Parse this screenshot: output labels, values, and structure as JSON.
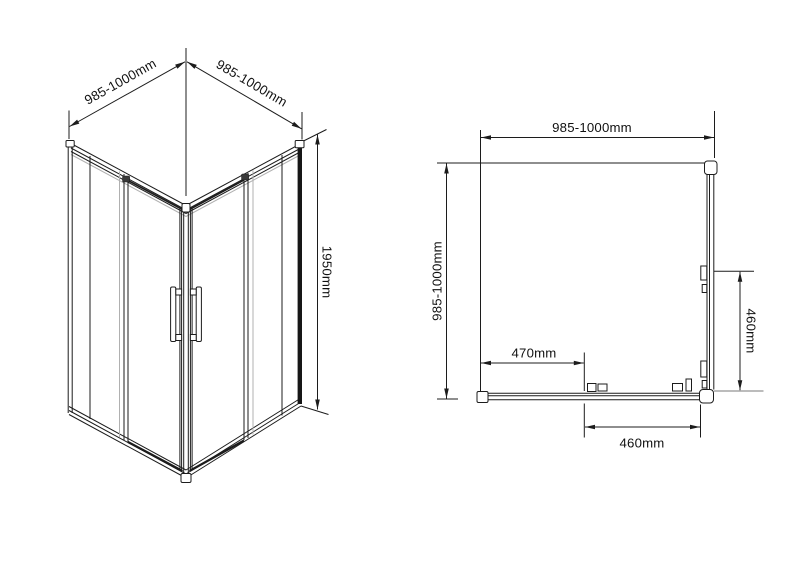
{
  "colors": {
    "line": "#1c1c1c",
    "background": "#ffffff",
    "gray_highlight": "#b0b0b0"
  },
  "iso": {
    "dim_width_left": "985-1000mm",
    "dim_width_right": "985-1000mm",
    "dim_height": "1950mm"
  },
  "plan": {
    "dim_width_top": "985-1000mm",
    "dim_depth_left": "985-1000mm",
    "dim_panel_inset": "470mm",
    "dim_opening_bottom": "460mm",
    "dim_opening_right": "460mm"
  }
}
